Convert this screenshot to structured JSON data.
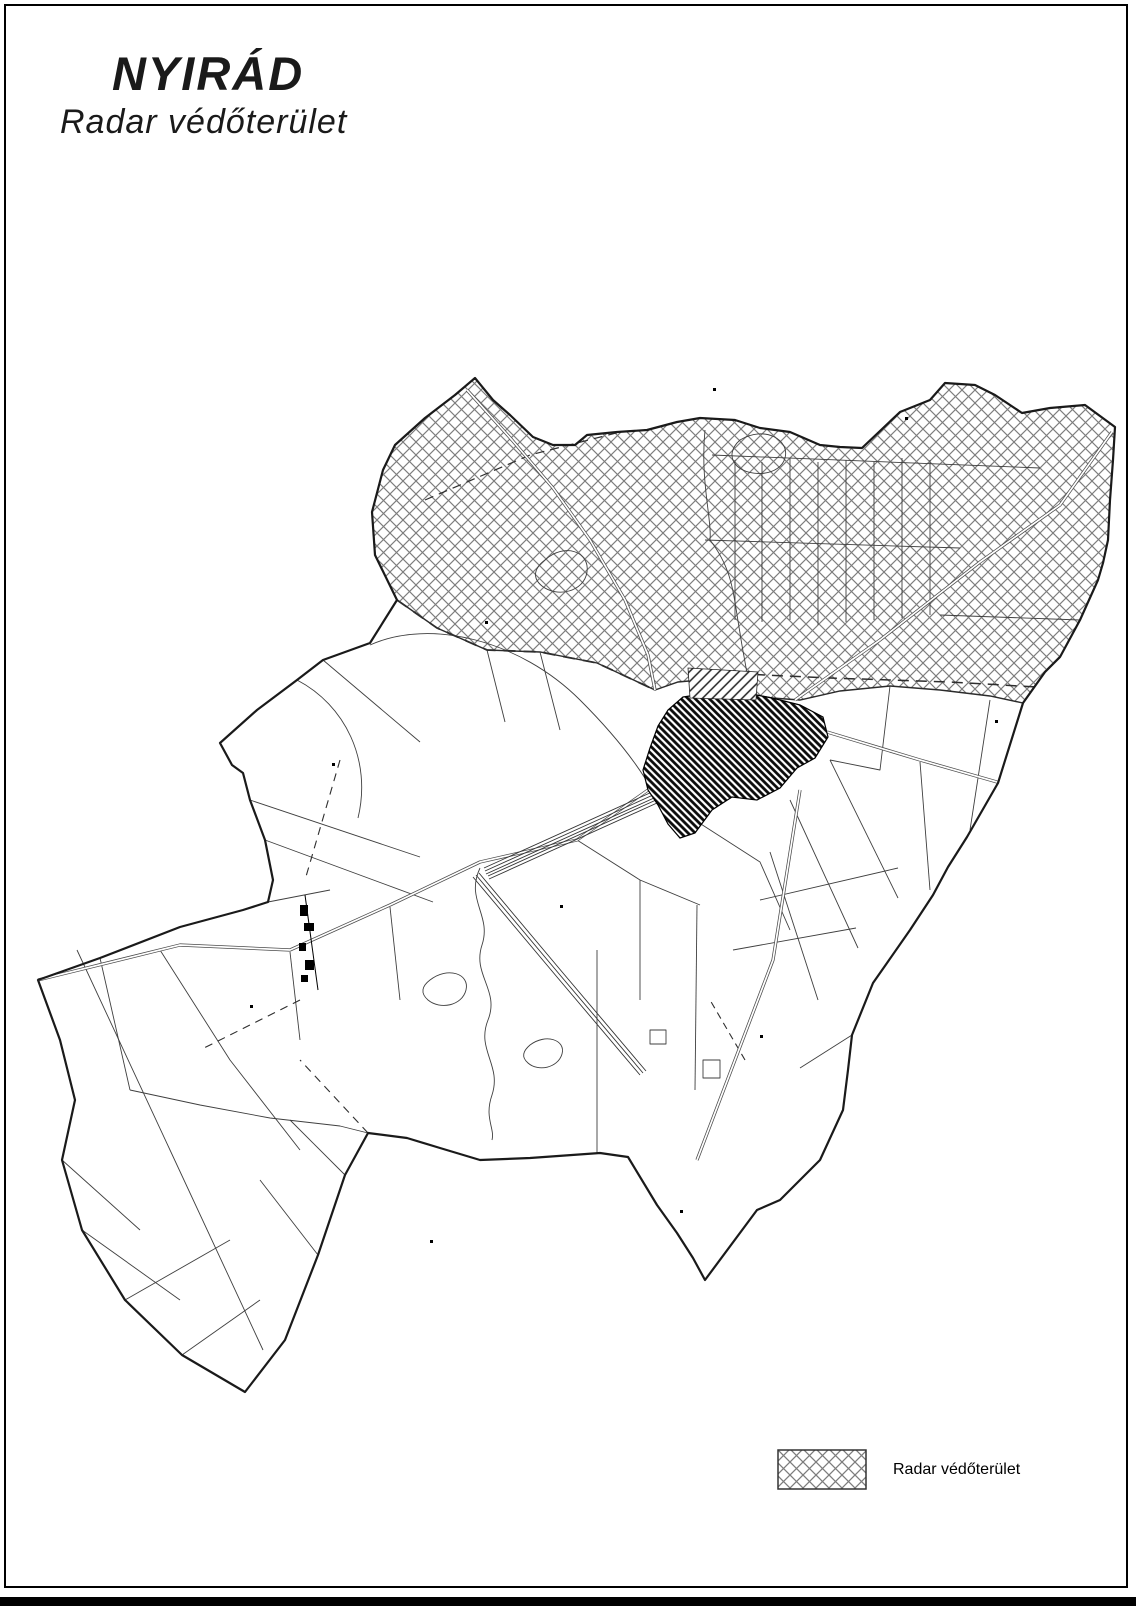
{
  "page": {
    "title": "NYIRÁD",
    "subtitle": "Radar védőterület"
  },
  "legend": {
    "items": [
      {
        "id": "radar-protection-area",
        "label": "Radar védőterület",
        "swatch": "diagonal-crosshatch"
      }
    ]
  },
  "map": {
    "colors": {
      "background": "#ffffff",
      "municipal_boundary": "#1a1a1a",
      "hatch_lines": "#7d7d7d",
      "parcel_lines": "#3f3f3f",
      "village_fill": "#0a0a0a"
    }
  }
}
